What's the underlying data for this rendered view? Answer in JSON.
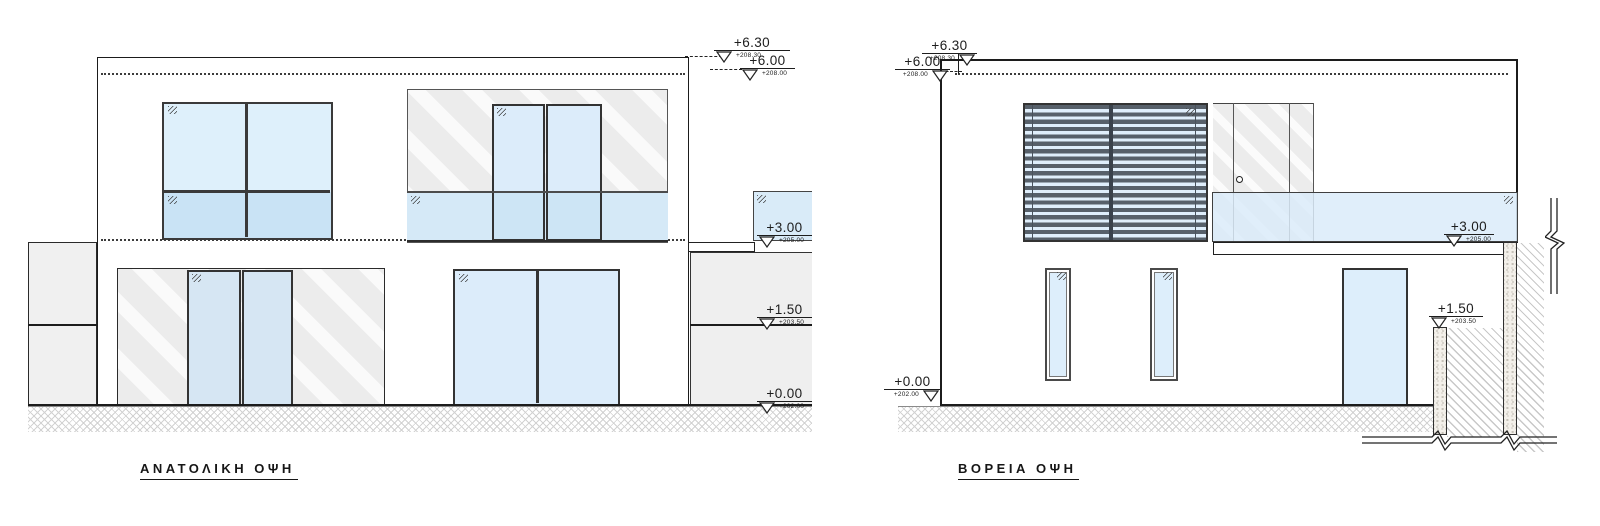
{
  "drawing": {
    "left_elevation": {
      "title": "ΑΝΑΤΟΛΙΚΗ ΟΨΗ"
    },
    "right_elevation": {
      "title": "ΒΟΡΕΙΑ ΟΨΗ"
    },
    "levels": {
      "p630": {
        "value": "+6.30",
        "datum": "+208.30"
      },
      "p600": {
        "value": "+6.00",
        "datum": "+208.00"
      },
      "p300": {
        "value": "+3.00",
        "datum": "+205.00"
      },
      "p150": {
        "value": "+1.50",
        "datum": "+203.50"
      },
      "p000": {
        "value": "+0.00",
        "datum": "+202.00"
      }
    },
    "colors": {
      "line": "#1c1c1c",
      "glass_light": "#def0fb",
      "glass_medium": "#c9e3f5",
      "railing_glass": "#d9ebf8",
      "wall_gray": "#ededed",
      "louver_slat": "#57606a",
      "concrete": "#f3f0ea"
    },
    "icons": {
      "level_marker_triangle_icon": "▽",
      "glass_pane_tick_icon": "〃",
      "door_handle_icon": "○"
    }
  }
}
